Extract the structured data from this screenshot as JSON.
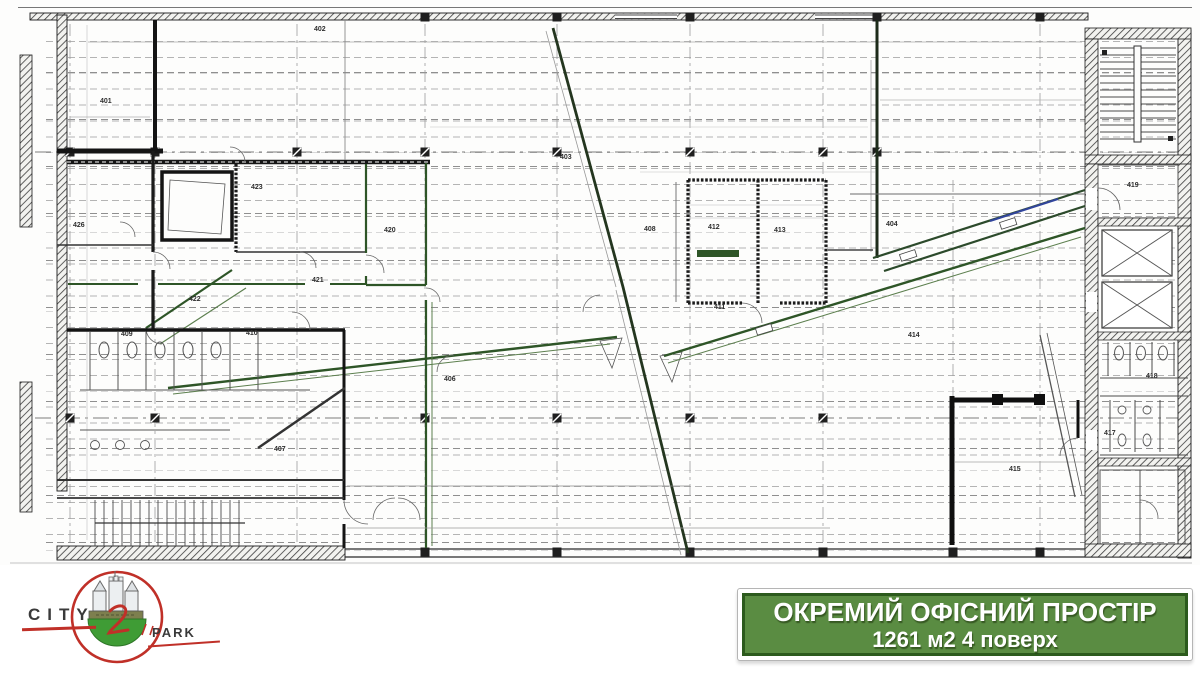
{
  "banner": {
    "line1": "ОКРЕМИЙ ОФІСНИЙ ПРОСТІР",
    "line2": "1261 м2 4 поверх",
    "background_color": "#5a8c42",
    "border_color": "#2c5a1d",
    "text_color": "#ffffff"
  },
  "logo": {
    "left_text": "CITY",
    "right_text": "PARK",
    "circle_color": "#c03028",
    "base_color": "#3f9c35",
    "castle_color": "#e9edf0"
  },
  "plan": {
    "wall_green": "#2e5527",
    "wall_ink": "#1a1a1a",
    "rooms": {
      "r401": "401",
      "r402": "402",
      "r403": "403",
      "r404": "404",
      "r406": "406",
      "r407": "407",
      "r408": "408",
      "r409": "409",
      "r410": "410",
      "r411": "411",
      "r412": "412",
      "r413": "413",
      "r414": "414",
      "r415": "415",
      "r417": "417",
      "r418": "418",
      "r419": "419",
      "r420": "420",
      "r421": "421",
      "r422": "422",
      "r423": "423",
      "r426": "426"
    }
  }
}
